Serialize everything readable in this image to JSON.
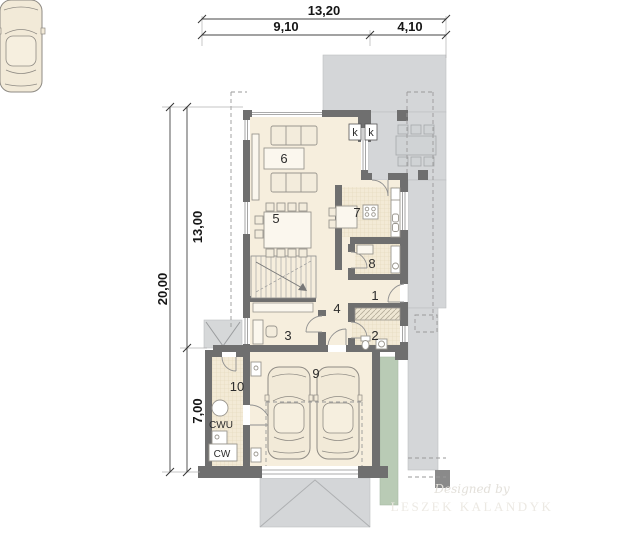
{
  "dimensions": {
    "width_total": "13,20",
    "width_left": "9,10",
    "width_right": "4,10",
    "height_total": "20,00",
    "height_upper": "13,00",
    "height_lower": "7,00"
  },
  "rooms": {
    "hall": "1",
    "wc": "2",
    "office": "3",
    "corridor": "4",
    "dining_room": "5",
    "living_room": "6",
    "kitchen": "7",
    "bathroom": "8",
    "garage": "9",
    "utility_room": "10"
  },
  "markers": {
    "k_left": "k",
    "k_right": "k",
    "hot_water_tank": "CWU",
    "boiler": "CW"
  },
  "watermark": {
    "line1": "Designed by",
    "line2": "LESZEK KALANDYK"
  },
  "colors": {
    "wall": "#6f6f6f",
    "floor": "#f6eedd",
    "hatched_floor": "#f3ead6",
    "paving": "#d4d6d8",
    "grass": "#b9cbb5",
    "outline": "#9a9a9a",
    "dimension": "#161616"
  }
}
